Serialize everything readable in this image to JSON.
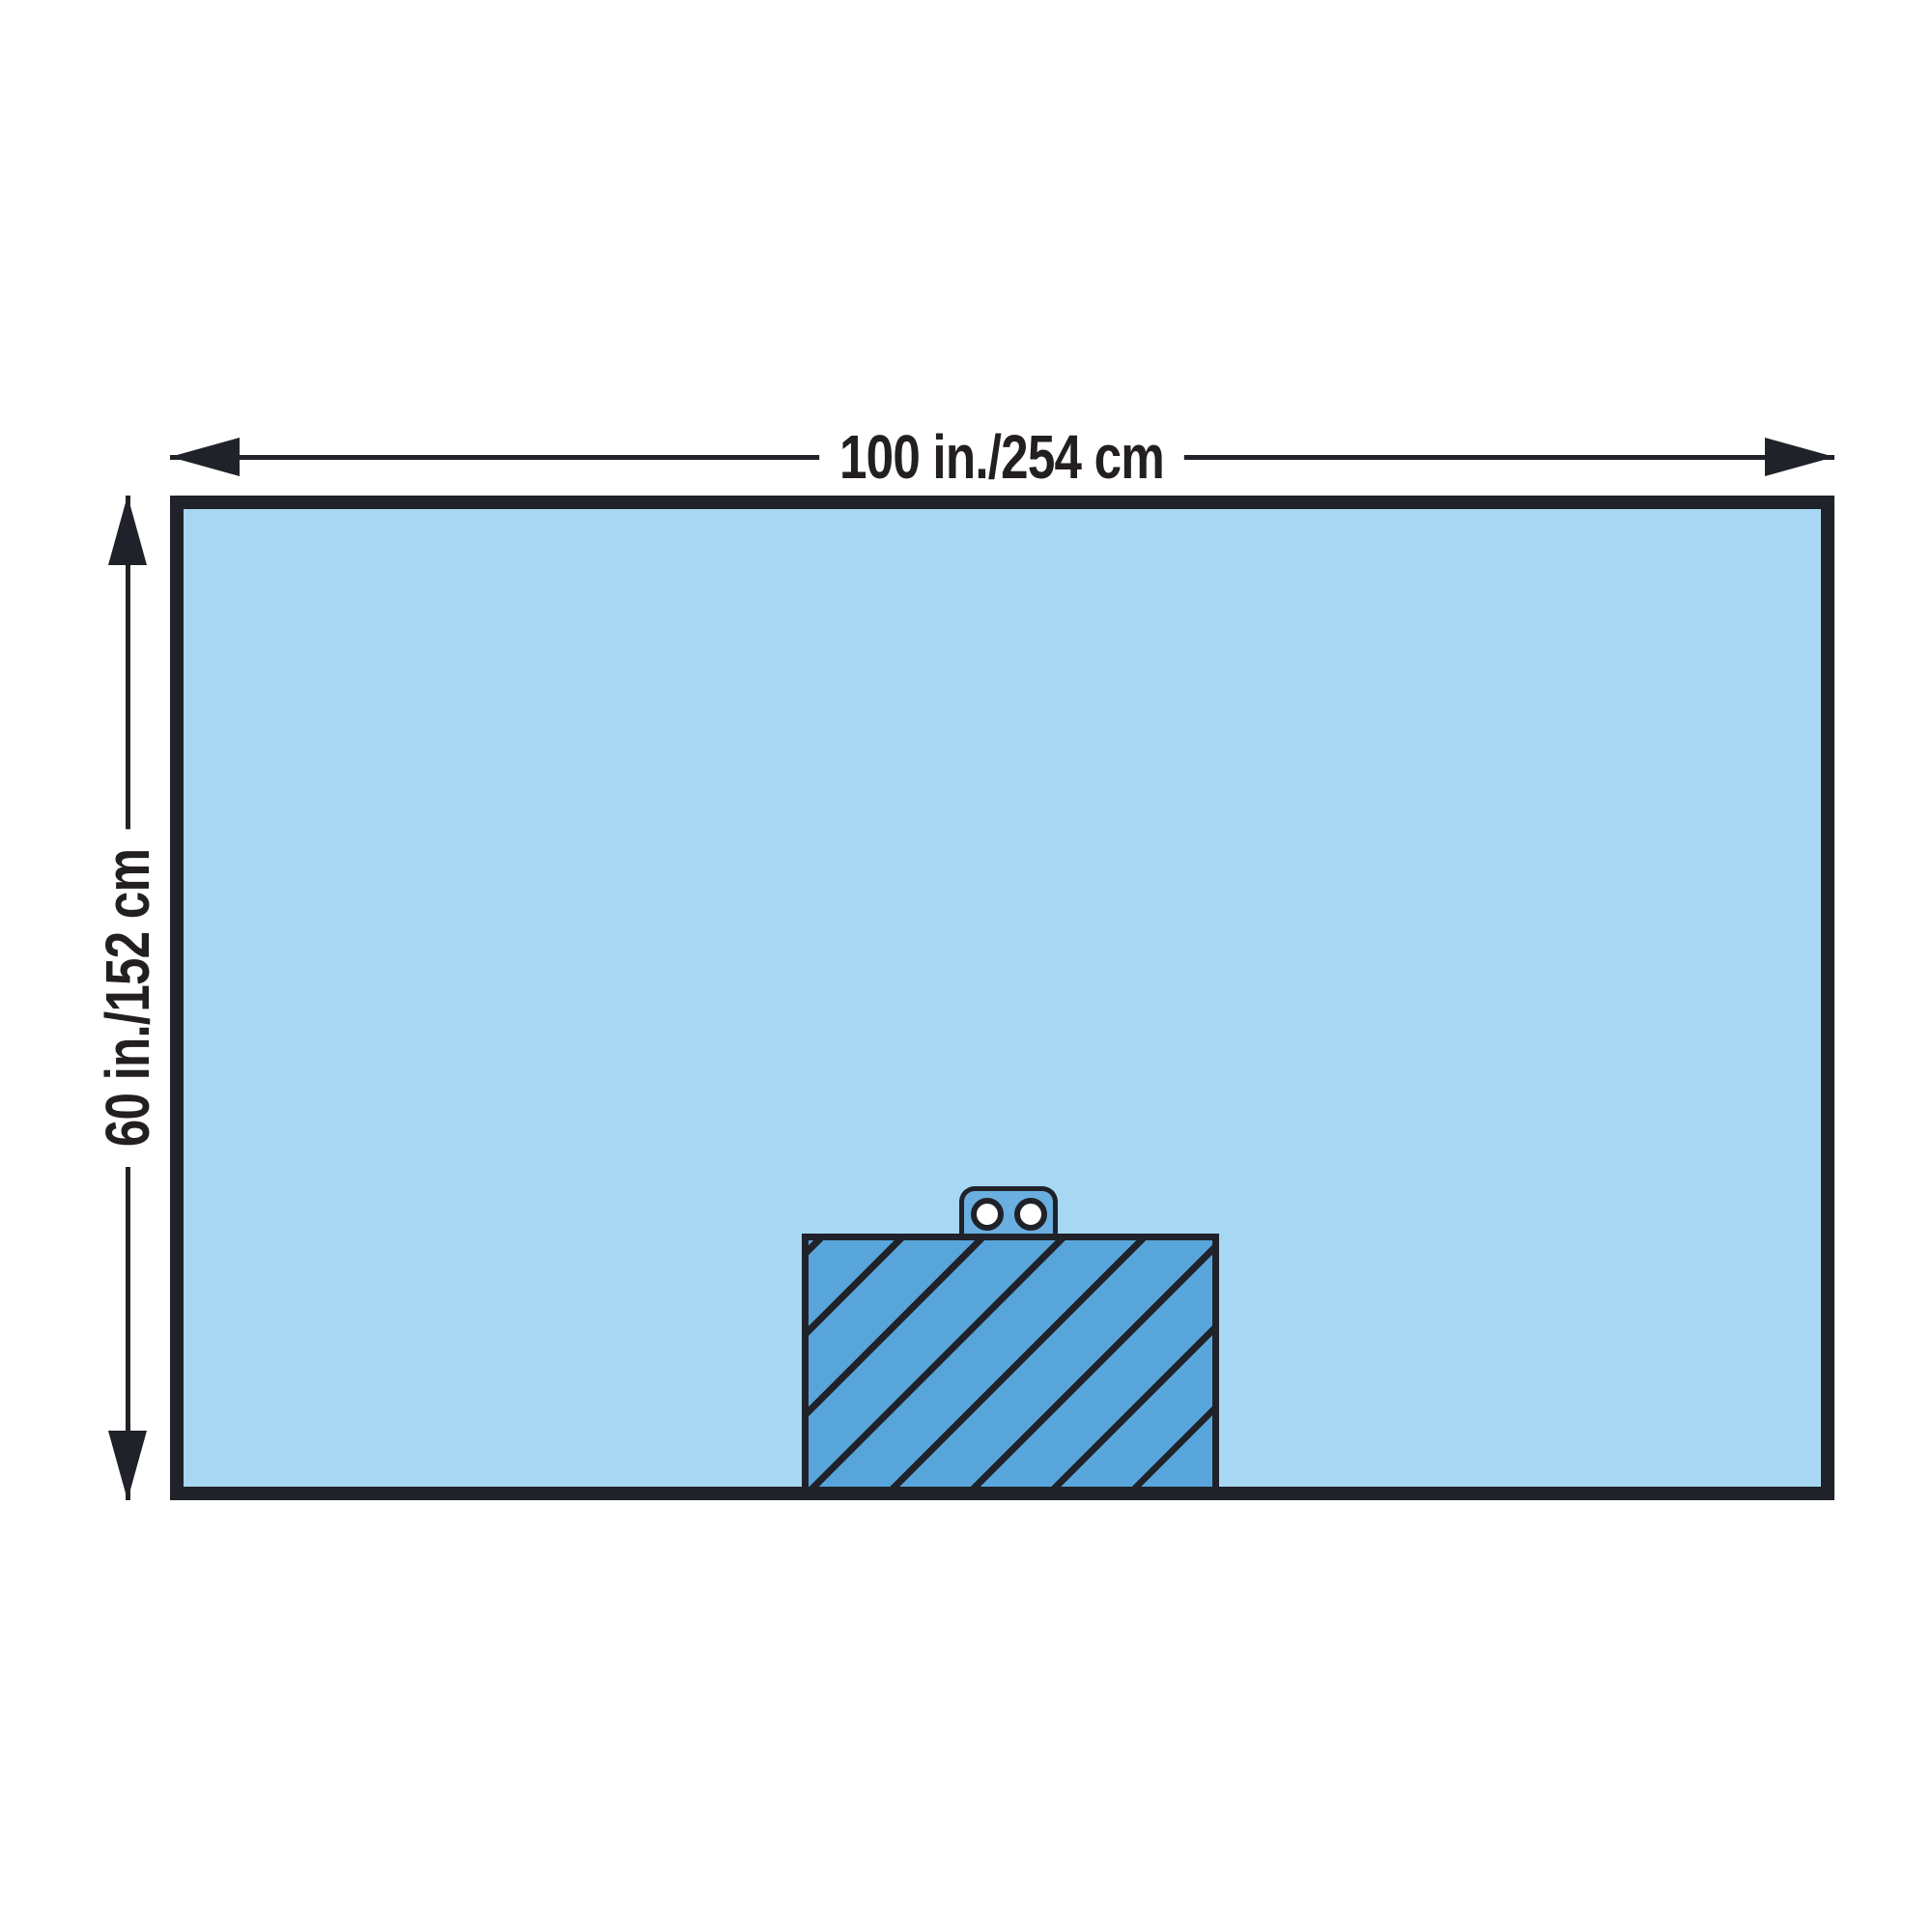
{
  "diagram": {
    "title": "Surgical drape dimensional diagram",
    "width_label": "100 in./254 cm",
    "height_label": "60 in./152 cm"
  },
  "colors": {
    "background": "#FFFFFF",
    "drape_fill": "#A7D7F2",
    "reinforcement_fill": "#57A5DA",
    "tab_fill": "#6AAFDF",
    "hole_fill": "#FFFFFF",
    "ink": "#202229",
    "text": "#231F20"
  }
}
